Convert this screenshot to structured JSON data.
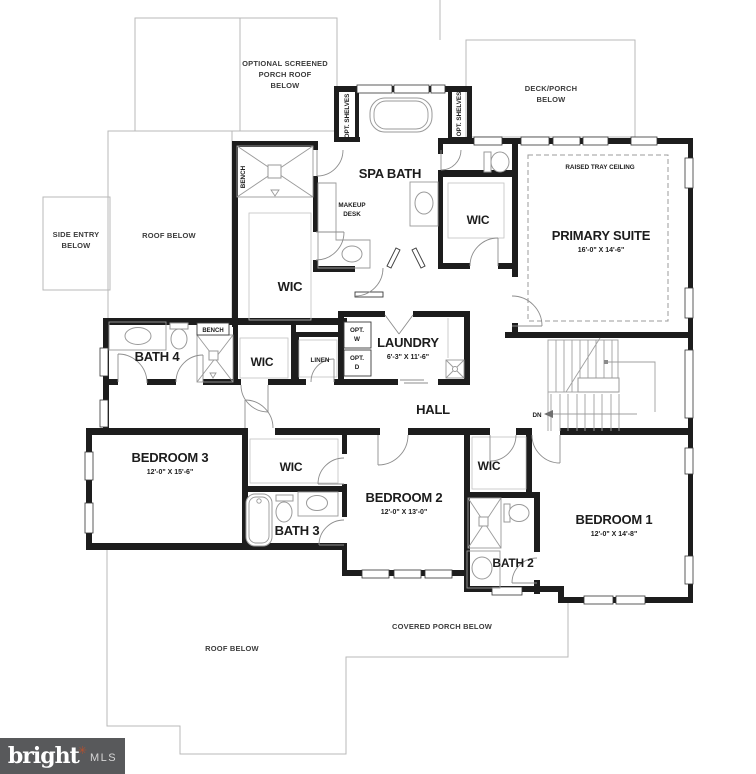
{
  "plan": {
    "rooms": {
      "spa_bath": {
        "name": "SPA BATH"
      },
      "primary_suite": {
        "name": "PRIMARY SUITE",
        "dims": "16'-0\" X 14'-6\""
      },
      "wic_primary_a": {
        "name": "WIC"
      },
      "wic_primary_b": {
        "name": "WIC"
      },
      "wic_hall": {
        "name": "WIC"
      },
      "wic_bedroom2": {
        "name": "WIC"
      },
      "wic_bedroom1": {
        "name": "WIC"
      },
      "bath4": {
        "name": "BATH 4"
      },
      "bath3": {
        "name": "BATH 3"
      },
      "bath2": {
        "name": "BATH 2"
      },
      "laundry": {
        "name": "LAUNDRY",
        "dims": "6'-3\" X 11'-6\""
      },
      "hall": {
        "name": "HALL"
      },
      "bedroom3": {
        "name": "BEDROOM 3",
        "dims": "12'-0\" X 15'-6\""
      },
      "bedroom2": {
        "name": "BEDROOM 2",
        "dims": "12'-0\" X 13'-0\""
      },
      "bedroom1": {
        "name": "BEDROOM 1",
        "dims": "12'-0\" X 14'-8\""
      }
    },
    "annotations": {
      "optional_porch_lines": [
        "OPTIONAL SCREENED",
        "PORCH ROOF",
        "BELOW"
      ],
      "deck_porch_lines": [
        "DECK/PORCH",
        "BELOW"
      ],
      "side_entry_lines": [
        "SIDE ENTRY",
        "BELOW"
      ],
      "roof_below_upper": "ROOF BELOW",
      "roof_below_lower": "ROOF BELOW",
      "covered_porch": "COVERED PORCH BELOW",
      "raised_tray_ceiling": "RAISED TRAY CEILING",
      "makeup_desk_lines": [
        "MAKEUP",
        "DESK"
      ],
      "opt_shelves_left": "OPT. SHELVES",
      "opt_shelves_right": "OPT. SHELVES",
      "bench_primary_shower": "BENCH",
      "bench_bath4": "BENCH",
      "linen": "LINEN",
      "opt_washer_lines": [
        "OPT.",
        "W"
      ],
      "opt_dryer_lines": [
        "OPT.",
        "D"
      ],
      "down": "DN"
    },
    "logo": {
      "brand": "bright",
      "mark": "✳",
      "suffix": "MLS"
    },
    "colors": {
      "wall": "#1d1d1d",
      "thin_line": "#b9b9b9",
      "fixture_line": "#9a9a9a",
      "door_line": "#8d8d8d",
      "label": "#1c1c1c",
      "logo_bg": "#58595b",
      "logo_accent": "#b5502e"
    }
  }
}
